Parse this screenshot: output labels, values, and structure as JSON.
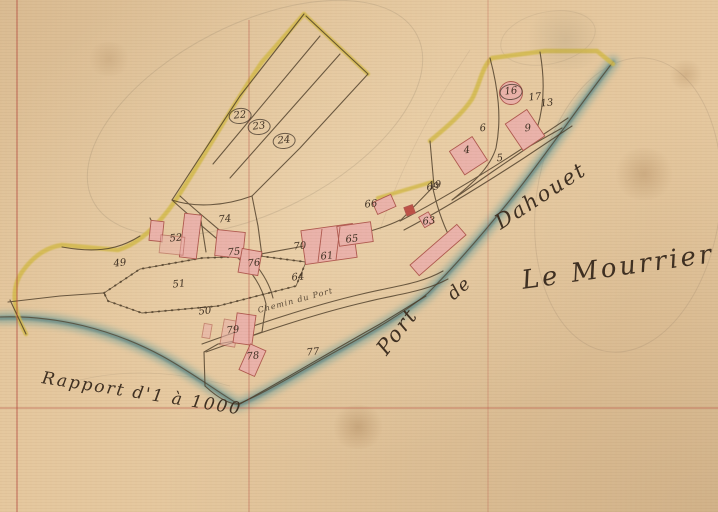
{
  "map": {
    "type": "historical cadastral map (scanned manuscript)",
    "place_labels": {
      "port": "Port",
      "de": "de",
      "dahouet": "Dahouet",
      "place_name": "Le Mourrier",
      "scale_note": "Rapport d'1 à 1000",
      "road_label": "Chemin du Port"
    },
    "parcel_numbers": [
      {
        "label": "22",
        "x": 240,
        "y": 116,
        "circled": true
      },
      {
        "label": "23",
        "x": 259,
        "y": 127,
        "circled": true
      },
      {
        "label": "24",
        "x": 284,
        "y": 141,
        "circled": true
      },
      {
        "label": "74",
        "x": 225,
        "y": 220
      },
      {
        "label": "52",
        "x": 176,
        "y": 239
      },
      {
        "label": "75",
        "x": 234,
        "y": 253
      },
      {
        "label": "76",
        "x": 254,
        "y": 264
      },
      {
        "label": "51",
        "x": 179,
        "y": 285
      },
      {
        "label": "49",
        "x": 120,
        "y": 264
      },
      {
        "label": "50",
        "x": 205,
        "y": 312
      },
      {
        "label": "70",
        "x": 300,
        "y": 247
      },
      {
        "label": "61",
        "x": 327,
        "y": 257
      },
      {
        "label": "65",
        "x": 352,
        "y": 240
      },
      {
        "label": "64",
        "x": 298,
        "y": 278
      },
      {
        "label": "66",
        "x": 371,
        "y": 205
      },
      {
        "label": "69",
        "x": 433,
        "y": 188
      },
      {
        "label": "63",
        "x": 429,
        "y": 222
      },
      {
        "label": "79",
        "x": 233,
        "y": 331
      },
      {
        "label": "78",
        "x": 253,
        "y": 357
      },
      {
        "label": "77",
        "x": 313,
        "y": 353
      },
      {
        "label": "16",
        "x": 511,
        "y": 92,
        "circled": true
      },
      {
        "label": "17",
        "x": 535,
        "y": 98
      },
      {
        "label": "13",
        "x": 547,
        "y": 104
      },
      {
        "label": "9",
        "x": 528,
        "y": 129
      },
      {
        "label": "6",
        "x": 483,
        "y": 129
      },
      {
        "label": "5",
        "x": 500,
        "y": 159
      },
      {
        "label": "4",
        "x": 467,
        "y": 151
      },
      {
        "label": "19",
        "x": 435,
        "y": 186
      }
    ],
    "colors": {
      "parchment": "#e5c89f",
      "water": "#76a39d",
      "water_dark": "#4e7c80",
      "road_yellow": "#d4bb4e",
      "building_pink": "#eab3ab",
      "building_pink_stroke": "#b05a50",
      "building_red": "#bf5248",
      "ink": "#3f3022",
      "ink_line": "#4c3c28",
      "grid_red": "#b2453a",
      "pencil": "#8a7a62"
    }
  }
}
